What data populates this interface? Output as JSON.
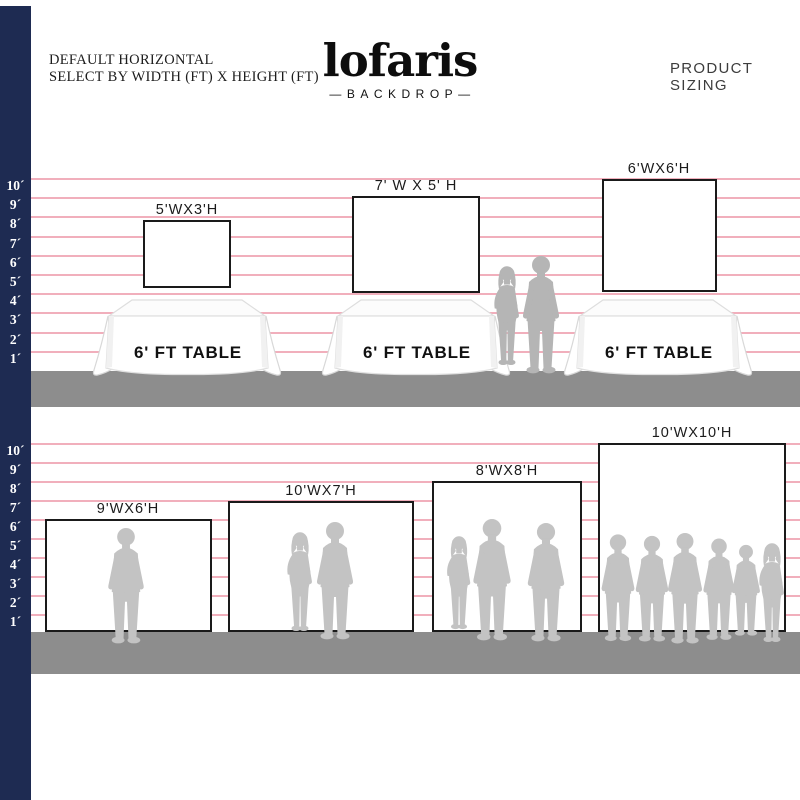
{
  "colors": {
    "navy": "#1e2b52",
    "pink": "#f0a6b5",
    "floor": "#8d8d8d",
    "border": "#1a1a1a",
    "sil_dark": "#b5b5b5",
    "sil_light": "#c3c3c3",
    "brand": "#0d0d0d"
  },
  "header": {
    "note_line1": "DEFAULT HORIZONTAL",
    "note_line2": "SELECT BY WIDTH (FT) X HEIGHT (FT)",
    "brand": "lofaris",
    "brand_sub": "—BACKDROP—",
    "title": "PRODUCT SIZING"
  },
  "ruler_top": [
    "10´",
    "9´",
    "8´",
    "7´",
    "6´",
    "5´",
    "4´",
    "3´",
    "2´",
    "1´"
  ],
  "ruler_bottom": [
    "10´",
    "9´",
    "8´",
    "7´",
    "6´",
    "5´",
    "4´",
    "3´",
    "2´",
    "1´"
  ],
  "top_section": {
    "backdrops": [
      {
        "label": "5'WX3'H",
        "width_ft": 5,
        "height_ft": 3
      },
      {
        "label": "7' W X 5' H",
        "width_ft": 7,
        "height_ft": 5
      },
      {
        "label": "6'WX6'H",
        "width_ft": 6,
        "height_ft": 6
      }
    ],
    "tables": [
      {
        "label": "6' FT TABLE"
      },
      {
        "label": "6' FT TABLE"
      },
      {
        "label": "6' FT TABLE"
      }
    ]
  },
  "bottom_section": {
    "backdrops": [
      {
        "label": "9'WX6'H",
        "width_ft": 9,
        "height_ft": 6
      },
      {
        "label": "10'WX7'H",
        "width_ft": 10,
        "height_ft": 7
      },
      {
        "label": "8'WX8'H",
        "width_ft": 8,
        "height_ft": 8
      },
      {
        "label": "10'WX10'H",
        "width_ft": 10,
        "height_ft": 10
      }
    ]
  }
}
